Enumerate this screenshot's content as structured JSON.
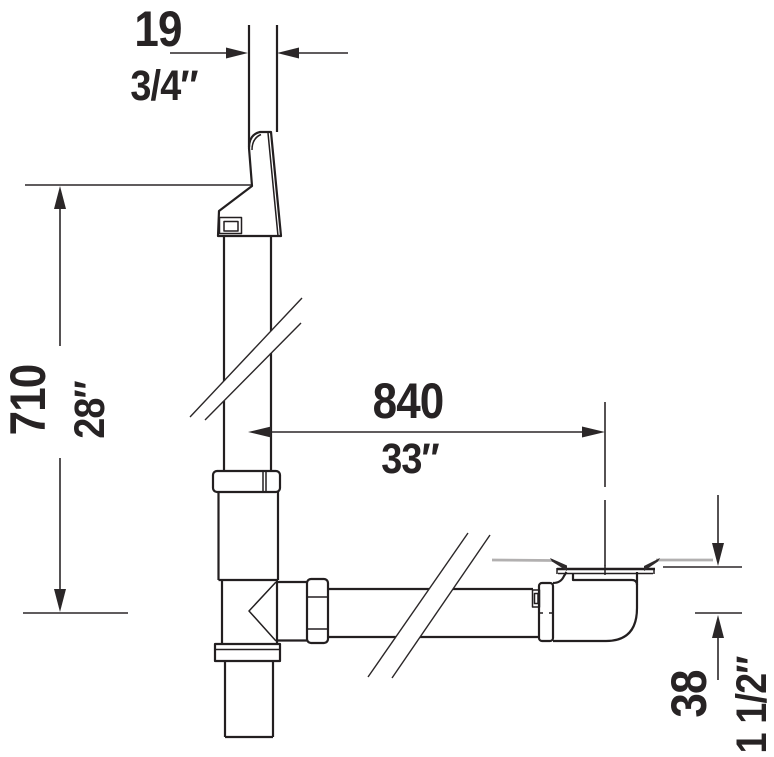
{
  "drawing": {
    "kind": "bathtub waste and overflow set - side elevation technical drawing",
    "colors": {
      "line": "#231f20",
      "text": "#272324",
      "floor_gray": "#b2b0b0",
      "background": "#ffffff"
    },
    "dimensions": {
      "overflow_conduit_width": {
        "mm": "19",
        "inch": "3/4″"
      },
      "overflow_height": {
        "mm": "710",
        "inch": "28″"
      },
      "horizontal_run": {
        "mm": "840",
        "inch": "33″"
      },
      "outlet_centre_depth": {
        "mm": "38",
        "inch": "1 1/2″"
      }
    }
  }
}
